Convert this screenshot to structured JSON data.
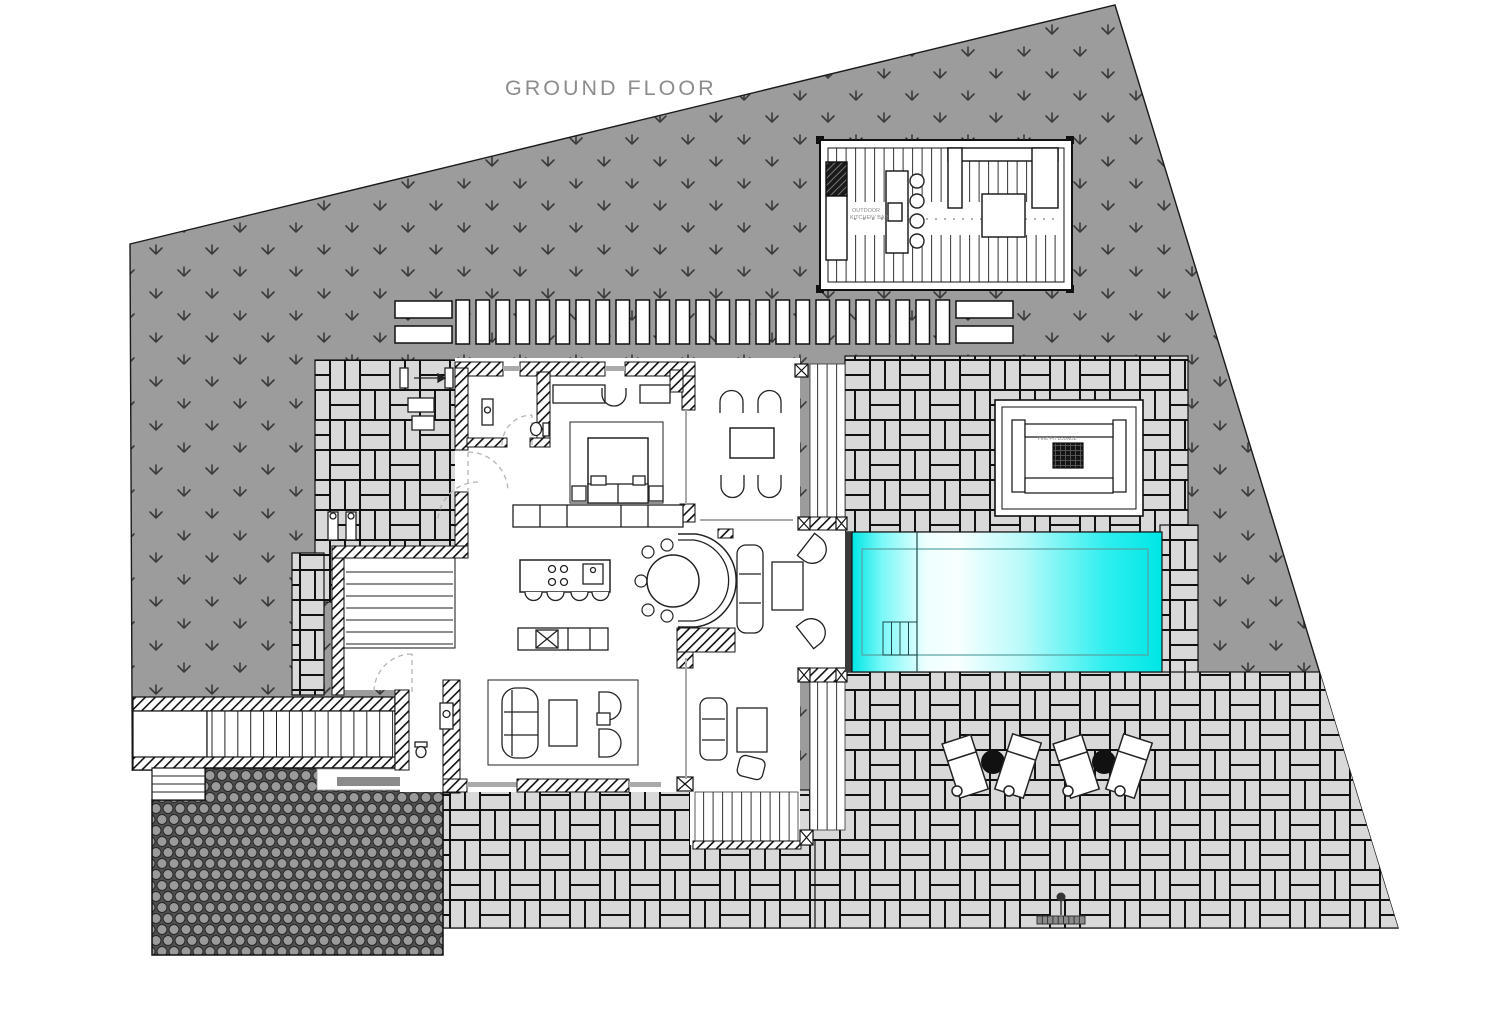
{
  "title": {
    "text": "GROUND FLOOR"
  },
  "labels": {
    "outdoor_kitchen_line1": "OUTDOOR",
    "outdoor_kitchen_line2": "KITCHEN/ BAR",
    "fire_pit_lounge": "FIRE PIT LOUNGE"
  },
  "colors": {
    "pool_cyan": "#00E6E6",
    "pool_highlight": "#F8FFFF",
    "grass_gray": "#9C9C9C",
    "grass_mark": "#3B3B3B",
    "paving_tile": "#D9D9D9",
    "paving_joint": "#111111",
    "cobble_stone": "#9A9A9A",
    "cobble_gap": "#4F4F4F",
    "wall_line": "#111111",
    "title_gray": "#8C8C8C",
    "glass_gray": "#AAAAAA"
  },
  "counts": {
    "boardwalk_planks": 25,
    "bar_stools": 4,
    "island_stools": 4,
    "dining_side_chairs": 5,
    "outdoor_dining_chairs": 4,
    "sun_lounger_groups": 2,
    "pool_step_treads": 4,
    "exterior_stair_treads": 15,
    "interior_stair_treads": 7,
    "side_step_treads": 3
  }
}
